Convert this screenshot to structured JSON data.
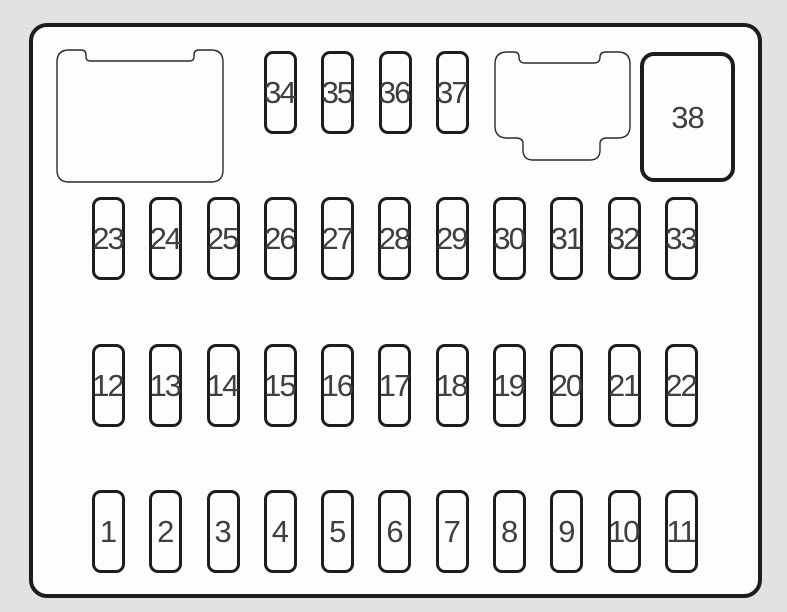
{
  "diagram_title": "fuse-box-diagram",
  "colors": {
    "background": "#e2e2e2",
    "panel_fill": "#fdfdfd",
    "line": "#1d1d1d",
    "thin_line": "#2a2a2a",
    "label": "#3f3f3f"
  },
  "rows": [
    {
      "name": "top",
      "fuses": [
        "34",
        "35",
        "36",
        "37"
      ]
    },
    {
      "name": "upper-middle",
      "fuses": [
        "23",
        "24",
        "25",
        "26",
        "27",
        "28",
        "29",
        "30",
        "31",
        "32",
        "33"
      ]
    },
    {
      "name": "lower-middle",
      "fuses": [
        "12",
        "13",
        "14",
        "15",
        "16",
        "17",
        "18",
        "19",
        "20",
        "21",
        "22"
      ]
    },
    {
      "name": "bottom",
      "fuses": [
        "1",
        "2",
        "3",
        "4",
        "5",
        "6",
        "7",
        "8",
        "9",
        "10",
        "11"
      ]
    }
  ],
  "large_fuse": {
    "label": "38"
  },
  "connectors": [
    {
      "name": "relay-block-outline"
    },
    {
      "name": "connector-socket-outline"
    }
  ]
}
